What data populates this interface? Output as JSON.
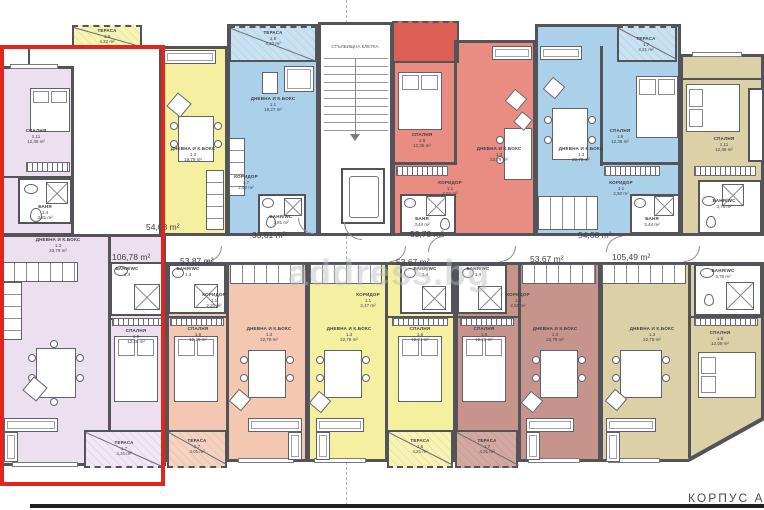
{
  "page": {
    "building_label": "КОРПУС А",
    "watermark": "address.bg"
  },
  "area_labels": {
    "yellow1": "54,08 m²",
    "blue1": "33,61 m²",
    "red1": "53,79 m²",
    "blue2": "54,08 m²",
    "lavender": "106,78 m²",
    "salmon": "53,87 m²",
    "yellow2": "53,67 m²",
    "brown": "53,67 m²",
    "beige": "105,49 m²"
  },
  "stairwell": {
    "label": "СТЪЛБИЩНА КЛЕТКА"
  },
  "rooms": {
    "lav_bed1": {
      "n": "СПАЛНЯ",
      "i": "1.11",
      "a": "12,35 m²"
    },
    "lav_bath1": {
      "n": "БАНЯ",
      "i": "1.4",
      "a": "3,81 m²"
    },
    "ter_yellow_top": {
      "n": "ТЕРАСА",
      "i": "1.8",
      "a": "4,22 m²"
    },
    "yel1_liv": {
      "n": "ДНЕВНА И К.БОКС",
      "i": "1.3",
      "a": "19,79 m²"
    },
    "blu1_ter": {
      "n": "ТЕРАСА",
      "i": "1.8",
      "a": "4,22 m²"
    },
    "blu1_liv": {
      "n": "ДНЕВНА И К.БОКС",
      "i": "1.1",
      "a": "18,27 m²"
    },
    "blu1_kor": {
      "n": "КОРИДОР",
      "i": "1.7",
      "a": "2,50 m²"
    },
    "blu1_bath": {
      "n": "БАНЯ/WC",
      "i": "1.4",
      "a": "3,81 m²"
    },
    "red_bed": {
      "n": "СПАЛНЯ",
      "i": "1.8",
      "a": "12,35 m²"
    },
    "red_liv": {
      "n": "ДНЕВНА И К.БОКС",
      "i": "1.3",
      "a": "22,78 m²"
    },
    "red_kor": {
      "n": "КОРИДОР",
      "i": "1.1",
      "a": "2,84 m²"
    },
    "red_bath": {
      "n": "БАНЯ",
      "i": "1.4",
      "a": "3,44 m²"
    },
    "blu2_ter": {
      "n": "ТЕРАСА",
      "i": "1.7",
      "a": "4,21 m²"
    },
    "blu2_liv": {
      "n": "ДНЕВНА И К.БОКС",
      "i": "1.3",
      "a": "22,78 m²"
    },
    "blu2_bed": {
      "n": "СПАЛНЯ",
      "i": "1.8",
      "a": "12,35 m²"
    },
    "blu2_kor": {
      "n": "КОРИДОР",
      "i": "1.1",
      "a": "2,50 m²"
    },
    "blu2_bath": {
      "n": "БАНЯ",
      "i": "1.4",
      "a": "3,44 m²"
    },
    "beiT_bed": {
      "n": "СПАЛНЯ",
      "i": "1.11",
      "a": "12,35 m²"
    },
    "beiT_bath": {
      "n": "БАНЯ/WC",
      "i": "1.4",
      "a": "3,75 m²"
    },
    "lav_liv": {
      "n": "ДНЕВНА И К.БОКС",
      "i": "1.3",
      "a": "33,79 m²"
    },
    "lav_bath2": {
      "n": "БАНЯ/WC",
      "i": "1.4",
      "a": ""
    },
    "lav_bed2": {
      "n": "СПАЛНЯ",
      "i": "1.9",
      "a": "12,26 m²"
    },
    "lav_ter": {
      "n": "ТЕРАСА",
      "i": "1.7",
      "a": "4,31 m²"
    },
    "sal_bath": {
      "n": "БАНЯ/WC",
      "i": "1.4",
      "a": ""
    },
    "sal_kor": {
      "n": "КОРИДОР",
      "i": "1.1",
      "a": "2,20 m²"
    },
    "sal_bed": {
      "n": "СПАЛНЯ",
      "i": "1.6",
      "a": "12,26 m²"
    },
    "sal_liv": {
      "n": "ДНЕВНА И К.БОКС",
      "i": "1.3",
      "a": "22,78 m²"
    },
    "sal_ter": {
      "n": "ТЕРАСА",
      "i": "1.7",
      "a": "4,01 m²"
    },
    "yel2_liv": {
      "n": "ДНЕВНА И К.БОКС",
      "i": "1.3",
      "a": "22,78 m²"
    },
    "yel2_kor": {
      "n": "КОРИДОР",
      "i": "1.1",
      "a": "2,47 m²"
    },
    "yel2_bath": {
      "n": "БАНЯ/WC",
      "i": "1.4",
      "a": ""
    },
    "yel2_bed": {
      "n": "СПАЛНЯ",
      "i": "1.6",
      "a": "12,04 m²"
    },
    "yel2_ter": {
      "n": "ТЕРАСА",
      "i": "1.6",
      "a": "4,21 m²"
    },
    "brn_bath": {
      "n": "БАНЯ/WC",
      "i": "1.4",
      "a": ""
    },
    "brn_kor": {
      "n": "КОРИДОР",
      "i": "1.1",
      "a": "2,50 m²"
    },
    "brn_bed": {
      "n": "СПАЛНЯ",
      "i": "1.6",
      "a": "12,26 m²"
    },
    "brn_liv": {
      "n": "ДНЕВНА И К.БОКС",
      "i": "1.3",
      "a": "22,78 m²"
    },
    "brn_ter": {
      "n": "ТЕРАСА",
      "i": "1.7",
      "a": "4,31 m²"
    },
    "beige_liv": {
      "n": "ДНЕВНА И К.БОКС",
      "i": "1.3",
      "a": "22,75 m²"
    },
    "beige_bed": {
      "n": "СПАЛНЯ",
      "i": "1.5",
      "a": "12,09 m²"
    },
    "beige_bath": {
      "n": "БАНЯ/WC",
      "i": "1.4",
      "a": "3,75 m²"
    }
  }
}
